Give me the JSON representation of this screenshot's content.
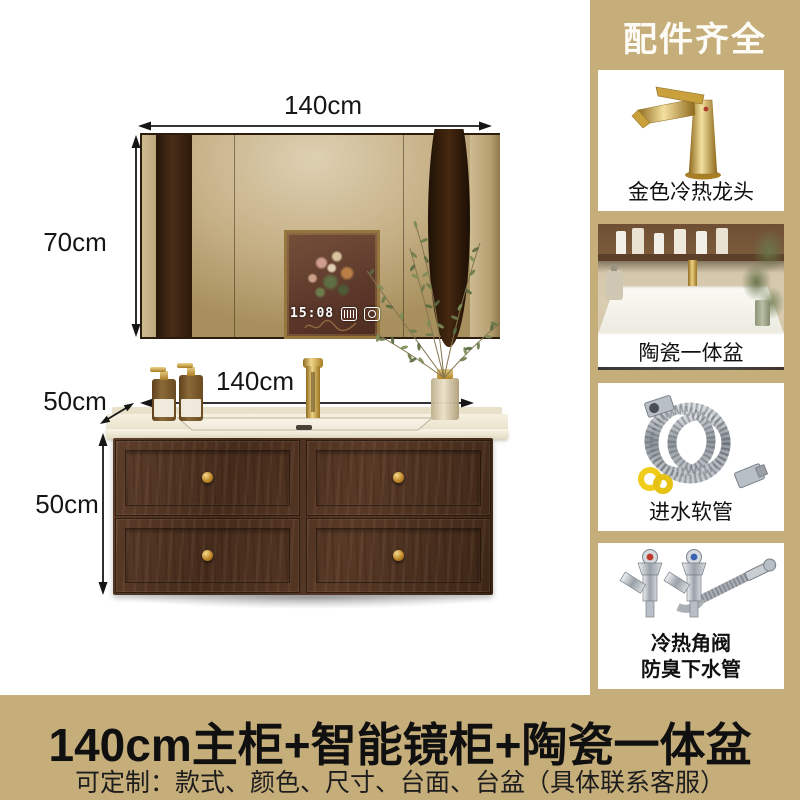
{
  "colors": {
    "sidebar_tan": "#C6AE7B",
    "gold": "#C9962E",
    "wood_dark": "#54382A",
    "counter_cream": "#EFE8D6",
    "text_dark": "#161616"
  },
  "scene": {
    "dims": {
      "mirror_width": "140cm",
      "mirror_height": "70cm",
      "counter_width": "140cm",
      "counter_depth": "50cm",
      "cabinet_height": "50cm"
    },
    "mirror_clock": "15:08"
  },
  "sidebar": {
    "header": "配件齐全",
    "items": [
      {
        "caption": "金色冷热龙头",
        "image": "gold-faucet"
      },
      {
        "caption": "陶瓷一体盆",
        "image": "ceramic-basin"
      },
      {
        "caption": "进水软管",
        "image": "inlet-hose"
      },
      {
        "caption_line1": "冷热角阀",
        "caption_line2": "防臭下水管",
        "image": "angle-valves-drain"
      }
    ]
  },
  "banner": {
    "title": "140cm主柜+智能镜柜+陶瓷一体盆",
    "subtitle": "可定制：款式、颜色、尺寸、台面、台盆（具体联系客服）"
  }
}
